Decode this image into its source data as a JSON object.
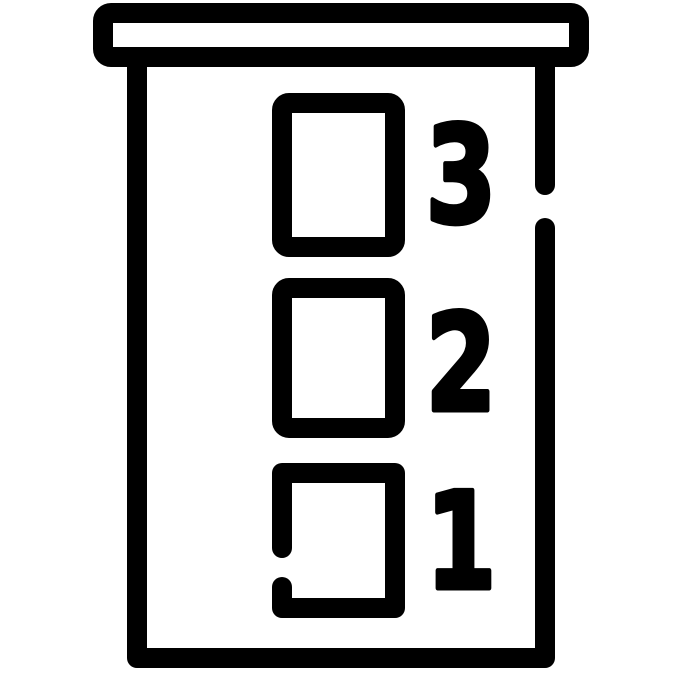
{
  "levels": [
    {
      "label": "1"
    },
    {
      "label": "2"
    },
    {
      "label": "3"
    }
  ],
  "colors": {
    "line": "#000000",
    "background": "#ffffff"
  }
}
